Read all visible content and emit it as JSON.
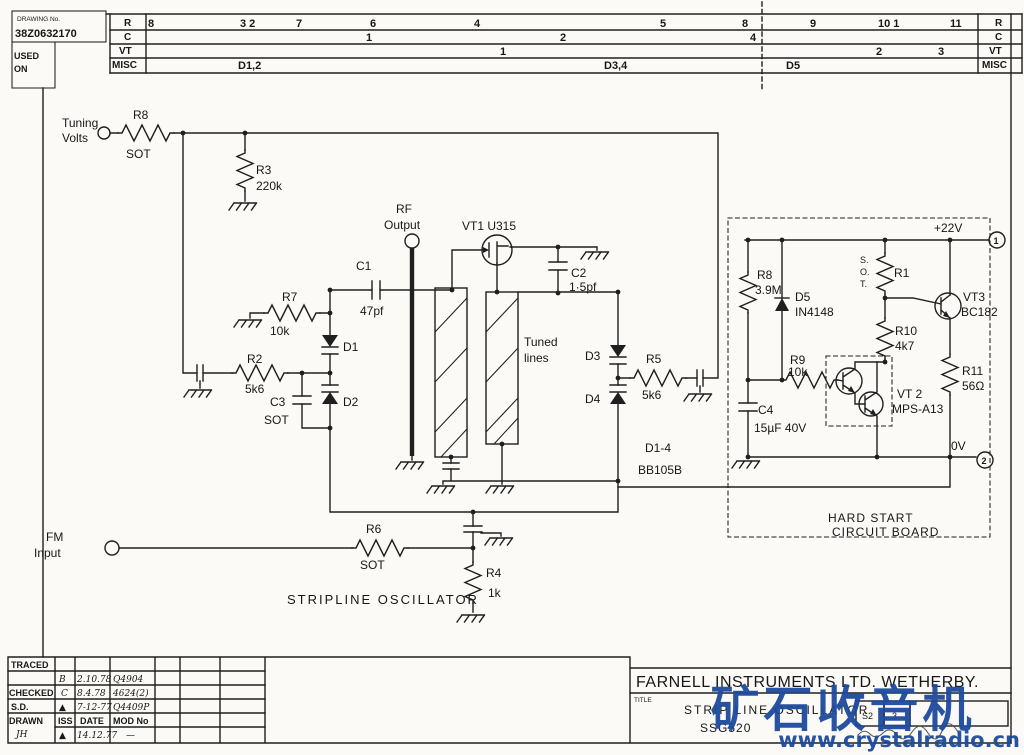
{
  "corner": {
    "drawing_no_label": "DRAWING No.",
    "drawing_no": "38Z0632170",
    "used_on_1": "USED",
    "used_on_2": "ON"
  },
  "rev": {
    "row_r": {
      "label": "R",
      "right_label": "R",
      "e0": "8",
      "e1": "3  2",
      "e2": "7",
      "e3": "6",
      "e4": "4",
      "e5": "5",
      "e6": "8",
      "e7": "9",
      "e8": "10 1",
      "e9": "11"
    },
    "row_c": {
      "label": "C",
      "right_label": "C",
      "e0": "1",
      "e1": "2",
      "e2": "4"
    },
    "row_vt": {
      "label": "VT",
      "right_label": "VT",
      "e0": "1",
      "e1": "2",
      "e2": "3"
    },
    "row_misc": {
      "label": "MISC",
      "right_label": "MISC",
      "e0": "D1,2",
      "e1": "D3,4",
      "e2": "D5"
    }
  },
  "sch": {
    "tuning_1": "Tuning",
    "tuning_2": "Volts",
    "r8a": "R8",
    "r8a_v": "SOT",
    "r3": "R3",
    "r3_v": "220k",
    "rf_1": "RF",
    "rf_2": "Output",
    "c1": "C1",
    "c1_v": "47pf",
    "vt1": "VT1 U315",
    "c2": "C2",
    "c2_v": "1·5pf",
    "r7": "R7",
    "r7_v": "10k",
    "d1": "D1",
    "d2": "D2",
    "r2": "R2",
    "r2_v": "5k6",
    "c3": "C3",
    "c3_v": "SOT",
    "tuned_1": "Tuned",
    "tuned_2": "lines",
    "d3": "D3",
    "d4": "D4",
    "r5": "R5",
    "r5_v": "5k6",
    "d14": "D1-4",
    "d14_v": "BB105B",
    "fm_1": "FM",
    "fm_2": "Input",
    "r6": "R6",
    "r6_v": "SOT",
    "r4": "R4",
    "r4_v": "1k",
    "stripline": "STRIPLINE OSCILLATOR"
  },
  "board": {
    "plus22": "+22V",
    "zero": "0V",
    "t1": "1",
    "t2": "2",
    "r8b": "R8",
    "r8b_v": "3.9M",
    "d5": "D5",
    "d5_v": "IN4148",
    "sot_1": "S.",
    "sot_2": "O.",
    "sot_3": "T.",
    "r1": "R1",
    "vt3": "VT3",
    "vt3_v": "BC182",
    "r10": "R10",
    "r10_v": "4k7",
    "r9": "R9",
    "r9_v": "10k",
    "vt2": "VT 2",
    "vt2_v": "MPS-A13",
    "r11": "R11",
    "r11_v": "56Ω",
    "c4": "C4",
    "c4_v": "15µF 40V",
    "name_1": "HARD START",
    "name_2": "CIRCUIT BOARD"
  },
  "tb": {
    "traced": "TRACED",
    "checked": "CHECKED",
    "sd": "S.D.",
    "drawn": "DRAWN",
    "drawn_init": "JH",
    "iss": "ISS",
    "date": "DATE",
    "mod": "MOD No",
    "r1_iss": "B",
    "r1_date": "2.10.78",
    "r1_mod": "Q4904",
    "r2_iss": "C",
    "r2_date": "8.4.78",
    "r2_mod": "4624(2)",
    "r3_iss": "▲",
    "r3_date": "7-12-77",
    "r3_mod": "Q4409P",
    "r4_iss": "▲",
    "r4_date": "14.12.77",
    "r4_mod": "—",
    "company": "FARNELL INSTRUMENTS LTD. WETHERBY.",
    "title_label": "TITLE",
    "title_1": "STRIP LINE OSCILLATOR",
    "title_2": "SSG520",
    "cell_s2": "S2",
    "cell_3": "3"
  },
  "watermark": {
    "text": "矿石收音机",
    "url": "www.crystalradio.cn"
  }
}
